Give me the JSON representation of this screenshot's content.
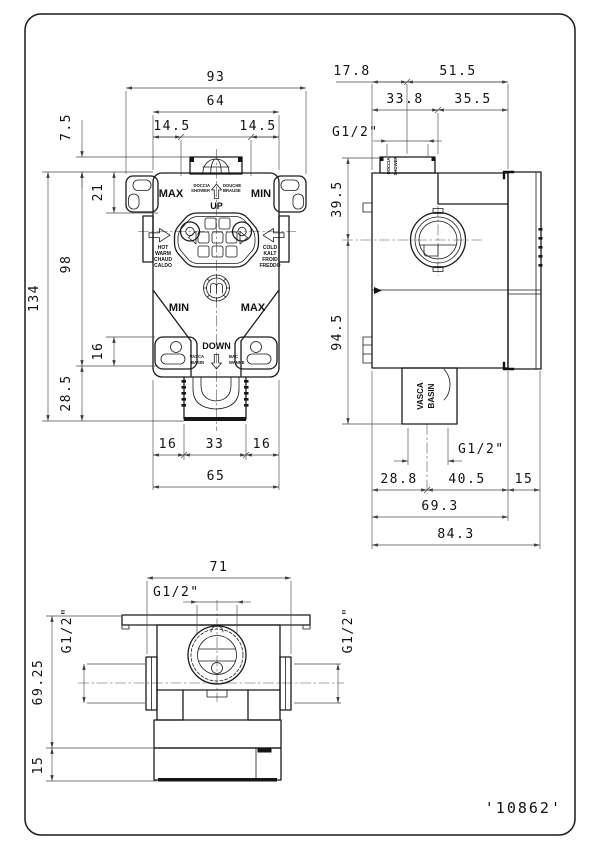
{
  "drawing": {
    "part_number": "'10862'",
    "front": {
      "dims": {
        "total_w": "93",
        "top_w": "64",
        "off_l": "14.5",
        "off_r": "14.5",
        "stub_h": "7.5",
        "ear_h": "21",
        "body_h": "98",
        "total_h": "134",
        "lower": "16",
        "bottom_h": "28.5",
        "out_l": "16",
        "out_c": "33",
        "out_r": "16",
        "body_w": "65"
      },
      "labels": {
        "max_top": "MAX",
        "min_top": "MIN",
        "up": "UP",
        "down": "DOWN",
        "min_bot": "MIN",
        "max_bot": "MAX",
        "shower": [
          "DOCCIA",
          "SHOWER"
        ],
        "shower2": [
          "DOUCHE",
          "BRAUSE"
        ],
        "hot": [
          "HOT",
          "WARM",
          "CHAUD",
          "CALDO"
        ],
        "cold": [
          "COLD",
          "KALT",
          "FROID",
          "FREDDO"
        ],
        "basin": [
          "VASCA",
          "BASIN"
        ],
        "basin2": [
          "BAC",
          "WANNE"
        ]
      }
    },
    "side": {
      "dims": {
        "a": "17.8",
        "b": "51.5",
        "c": "33.8",
        "d": "35.5",
        "e": "39.5",
        "f": "94.5",
        "g": "28.8",
        "h": "40.5",
        "i": "15",
        "j": "69.3",
        "k": "84.3",
        "thread_top": "G1/2\"",
        "thread_bot": "G1/2\""
      },
      "labels": {
        "port": [
          "DOCCIA",
          "SHOWER"
        ],
        "basin": [
          "VASCA",
          "BASIN"
        ]
      }
    },
    "bottom": {
      "dims": {
        "w": "71",
        "h": "69.25",
        "base": "15",
        "thread_c": "G1/2\"",
        "thread_l": "G1/2\"",
        "thread_r": "G1/2\""
      }
    },
    "colors": {
      "line": "#1b1b1b",
      "dim": "#4a4a4a",
      "bg": "#ffffff"
    }
  }
}
